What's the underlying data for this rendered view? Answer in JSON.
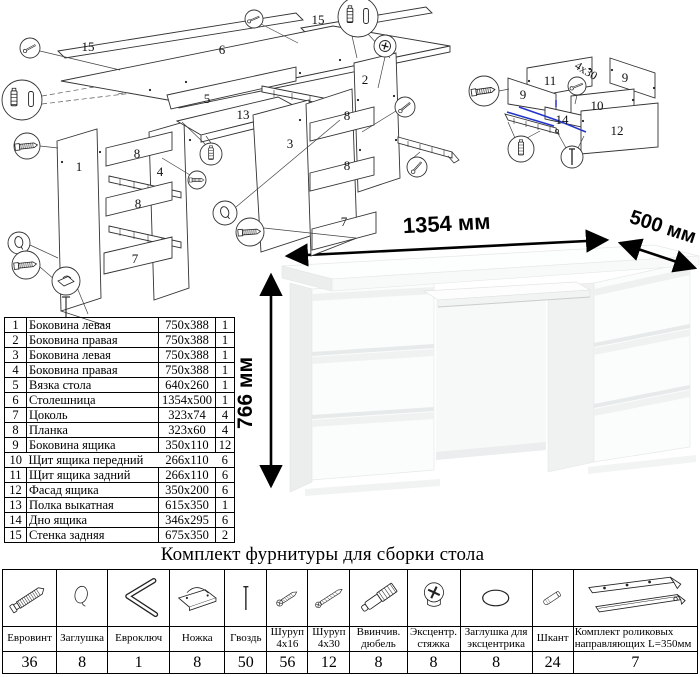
{
  "page": {
    "hardware_title": "Комплект фурнитуры для сборки стола"
  },
  "dimensions": {
    "width": "1354 мм",
    "depth": "500 мм",
    "height": "766 мм"
  },
  "exploded_view": {
    "labels": [
      "15",
      "6",
      "15",
      "1",
      "8",
      "4",
      "8",
      "7",
      "5",
      "13",
      "3",
      "2",
      "8",
      "8",
      "7"
    ]
  },
  "drawer_view": {
    "labels": [
      "11",
      "9",
      "9",
      "10",
      "14",
      "12"
    ],
    "note": "4x30"
  },
  "parts_table": {
    "rows": [
      {
        "num": "1",
        "name": "Боковина левая",
        "size": "750x388",
        "qty": "1"
      },
      {
        "num": "2",
        "name": "Боковина правая",
        "size": "750x388",
        "qty": "1"
      },
      {
        "num": "3",
        "name": "Боковина левая",
        "size": "750x388",
        "qty": "1"
      },
      {
        "num": "4",
        "name": "Боковина правая",
        "size": "750x388",
        "qty": "1"
      },
      {
        "num": "5",
        "name": "Вязка стола",
        "size": "640x260",
        "qty": "1"
      },
      {
        "num": "6",
        "name": "Столешница",
        "size": "1354x500",
        "qty": "1"
      },
      {
        "num": "7",
        "name": "Цоколь",
        "size": "323x74",
        "qty": "4"
      },
      {
        "num": "8",
        "name": "Планка",
        "size": "323x60",
        "qty": "4"
      },
      {
        "num": "9",
        "name": "Боковина ящика",
        "size": "350x110",
        "qty": "12"
      },
      {
        "num": "10",
        "name": "Щит ящика передний",
        "size": "266x110",
        "qty": "6"
      },
      {
        "num": "11",
        "name": "Щит ящика задний",
        "size": "266x110",
        "qty": "6"
      },
      {
        "num": "12",
        "name": "Фасад ящика",
        "size": "350x200",
        "qty": "6"
      },
      {
        "num": "13",
        "name": "Полка выкатная",
        "size": "615x350",
        "qty": "1"
      },
      {
        "num": "14",
        "name": "Дно ящика",
        "size": "346x295",
        "qty": "6"
      },
      {
        "num": "15",
        "name": "Стенка задняя",
        "size": "675x350",
        "qty": "2"
      }
    ]
  },
  "hardware_table": {
    "items": [
      {
        "name": "Евровинт",
        "qty": "36",
        "icon": "euro-screw-icon"
      },
      {
        "name": "Заглушка",
        "qty": "8",
        "icon": "cap-icon"
      },
      {
        "name": "Евроключ",
        "qty": "1",
        "icon": "hex-key-icon"
      },
      {
        "name": "Ножка",
        "qty": "8",
        "icon": "foot-icon"
      },
      {
        "name": "Гвоздь",
        "qty": "50",
        "icon": "nail-icon"
      },
      {
        "name": "Шуруп 4x16",
        "qty": "56",
        "icon": "screw-4x16-icon"
      },
      {
        "name": "Шуруп 4x30",
        "qty": "12",
        "icon": "screw-4x30-icon"
      },
      {
        "name": "Ввинчив. дюбель",
        "qty": "8",
        "icon": "screw-in-dowel-icon"
      },
      {
        "name": "Эксцентр. стяжка",
        "qty": "8",
        "icon": "eccentric-cam-icon"
      },
      {
        "name": "Заглушка для эксцентрика",
        "qty": "8",
        "icon": "eccentric-cap-icon"
      },
      {
        "name": "Шкант",
        "qty": "24",
        "icon": "wooden-dowel-icon"
      },
      {
        "name": "Комплект роликовых направляющих L=350мм",
        "qty": "7",
        "icon": "roller-guides-icon"
      }
    ]
  }
}
